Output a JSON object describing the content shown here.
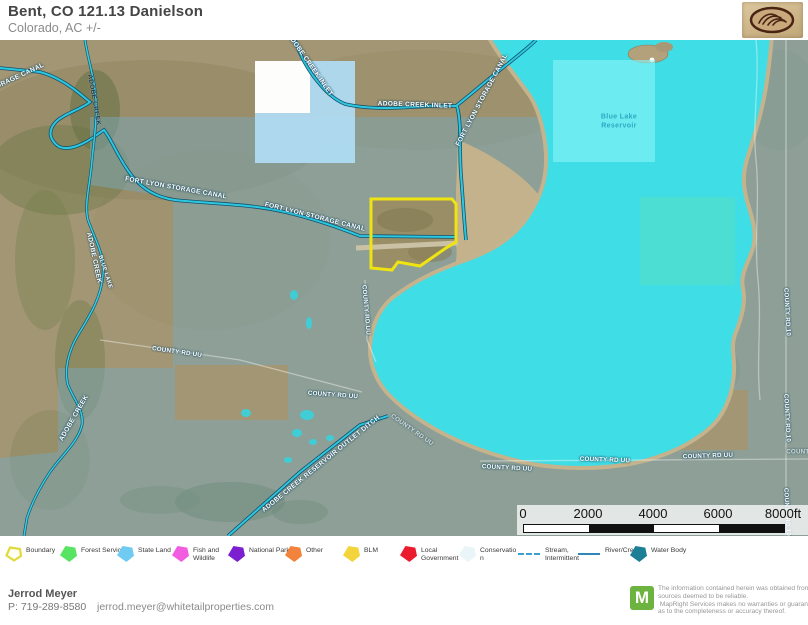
{
  "header": {
    "title": "Bent, CO 121.13 Danielson",
    "subtitle": "Colorado,  AC +/-"
  },
  "map": {
    "labels": [
      {
        "text": "ORAGE CANAL",
        "x": 20,
        "y": 36,
        "rot": -25
      },
      {
        "text": "ADOBE CREEK",
        "x": 94,
        "y": 60,
        "rot": 80,
        "cls": "dark"
      },
      {
        "text": "ADOBE CREEK INLET",
        "x": 310,
        "y": 25,
        "rot": 55
      },
      {
        "text": "ADOBE CREEK INLET",
        "x": 415,
        "y": 65,
        "rot": 2
      },
      {
        "text": "FORT LYON STORAGE CANAL",
        "x": 482,
        "y": 60,
        "rot": -62
      },
      {
        "text": "FORT LYON STORAGE CANAL",
        "x": 176,
        "y": 148,
        "rot": 10
      },
      {
        "text": "FORT LYON STORAGE CANAL",
        "x": 315,
        "y": 177,
        "rot": 14
      },
      {
        "text": "ADOBE CREEK",
        "x": 94,
        "y": 218,
        "rot": 78
      },
      {
        "text": "BLUE LAKE",
        "x": 105,
        "y": 232,
        "rot": 72,
        "cls": "small"
      },
      {
        "text": "ADOBE CREEK",
        "x": 74,
        "y": 378,
        "rot": -60
      },
      {
        "text": "Blue Lake Reservoir",
        "x": 619,
        "y": 82,
        "rot": 0,
        "cls": "lake"
      },
      {
        "text": "COUNTY RD UU",
        "x": 177,
        "y": 312,
        "rot": 8,
        "cls": "road"
      },
      {
        "text": "COUNTY RD UU",
        "x": 333,
        "y": 355,
        "rot": 4,
        "cls": "road"
      },
      {
        "text": "COUNTY RD UU",
        "x": 366,
        "y": 270,
        "rot": 85,
        "cls": "road"
      },
      {
        "text": "COUNTY RD UU",
        "x": 412,
        "y": 390,
        "rot": 35,
        "cls": "road faint"
      },
      {
        "text": "COUNTY RD UU",
        "x": 507,
        "y": 428,
        "rot": 3,
        "cls": "road"
      },
      {
        "text": "COUNTY RD UU",
        "x": 605,
        "y": 420,
        "rot": 2,
        "cls": "road"
      },
      {
        "text": "COUNTY RD UU",
        "x": 708,
        "y": 416,
        "rot": -2,
        "cls": "road"
      },
      {
        "text": "ADOBE CREEK RESERVOIR OUTLET DITCH",
        "x": 321,
        "y": 424,
        "rot": -39
      },
      {
        "text": "COUNTY RD 10",
        "x": 787,
        "y": 272,
        "rot": 87,
        "cls": "road"
      },
      {
        "text": "COUNTY RD 10",
        "x": 787,
        "y": 378,
        "rot": 87,
        "cls": "road"
      },
      {
        "text": "COUNTY RD 10",
        "x": 787,
        "y": 472,
        "rot": 87,
        "cls": "road"
      },
      {
        "text": "COUNTY",
        "x": 800,
        "y": 412,
        "rot": 0,
        "cls": "road faint"
      }
    ],
    "scale_bar": {
      "ticks": [
        "0",
        "2000",
        "4000",
        "6000",
        "8000ft"
      ]
    },
    "colors": {
      "water_body": "#3fdde5",
      "parcel_boundary": "#f0e312",
      "canal_line": "#2cc8e0",
      "overlay_tint": "#7eaab9",
      "state_land_parcel": "#b5def5",
      "lake_parcel": "#7df2f4"
    }
  },
  "legend": {
    "items": [
      {
        "label": "Boundary",
        "type": "area-outline",
        "color": "#e0da3c",
        "x": 5
      },
      {
        "label": "Forest Service",
        "type": "area",
        "color": "#58e463",
        "x": 60
      },
      {
        "label": "State Land",
        "type": "area",
        "color": "#6fcbf2",
        "x": 117
      },
      {
        "label": "Fish and Wildlife",
        "type": "area",
        "color": "#f25ce0",
        "x": 172
      },
      {
        "label": "National Park",
        "type": "area",
        "color": "#7b1fd0",
        "x": 228
      },
      {
        "label": "Other",
        "type": "area",
        "color": "#f2823c",
        "x": 285
      },
      {
        "label": "BLM",
        "type": "area",
        "color": "#f2d53c",
        "x": 343
      },
      {
        "label": "Local Government",
        "type": "area",
        "color": "#ea1c2e",
        "x": 400
      },
      {
        "label": "Conservation",
        "type": "area",
        "color": "#e9f5f8",
        "x": 459
      },
      {
        "label": "Stream, Intermittent",
        "type": "line-dashed",
        "color": "#3aa0d0",
        "x": 518
      },
      {
        "label": "River/Creek",
        "type": "line-solid",
        "color": "#2f86b8",
        "x": 578
      },
      {
        "label": "Water Body",
        "type": "area",
        "color": "#1c7f96",
        "x": 630
      }
    ]
  },
  "footer": {
    "agent_name": "Jerrod Meyer",
    "phone": "P: 719-289-8580",
    "email": "jerrod.meyer@whitetailproperties.com",
    "mapright_logo_letter": "M",
    "disclaimer_lines": [
      "The information contained herein was obtained from",
      "sources deemed to be reliable.",
      " MapRight Services makes no warranties or guarantees",
      "as to the completeness or accuracy thereof."
    ]
  }
}
